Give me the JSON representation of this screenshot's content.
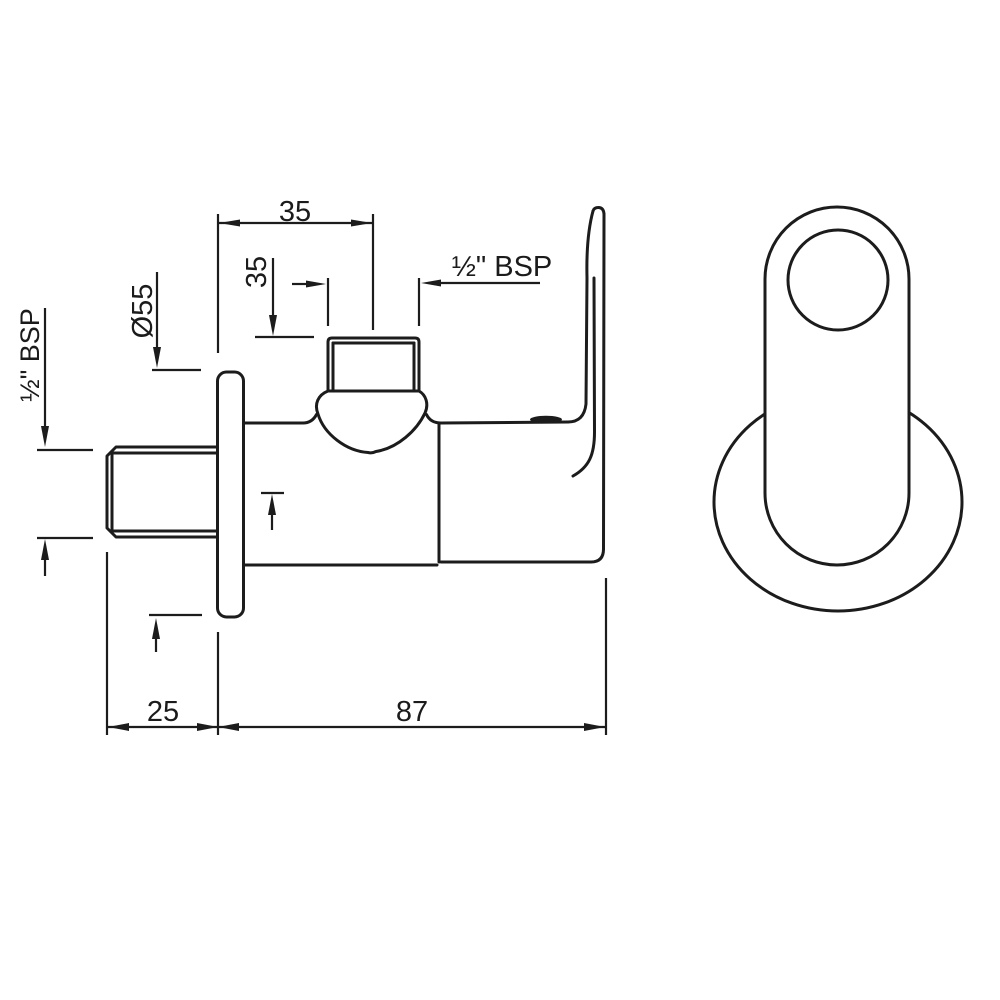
{
  "drawing": {
    "background_color": "#ffffff",
    "line_color": "#1c1c1c",
    "dimensions": {
      "wall_to_outlet_center": "35",
      "outlet_height_offset": "35",
      "flange_diameter": "Ø55",
      "outlet_thread": "½\" BSP",
      "inlet_thread": "½\" BSP",
      "wall_offset": "25",
      "body_length": "87"
    }
  }
}
